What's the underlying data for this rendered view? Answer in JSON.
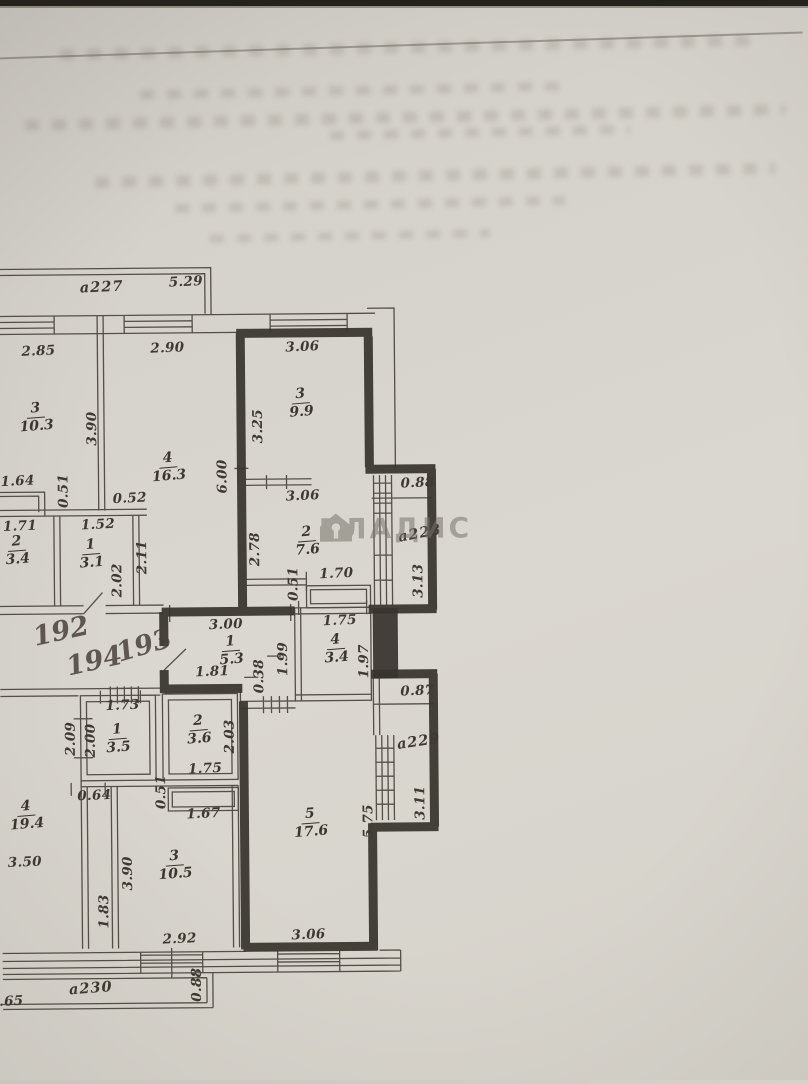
{
  "document": {
    "type": "BTI floor plan photo",
    "watermark_brand": "ВЛАДИС"
  },
  "colors": {
    "paper": "#d5d2cb",
    "ink": "#3f3931",
    "thick_wall": "#38342e",
    "watermark": "#78746c"
  },
  "apartment_numbers": [
    "192",
    "194",
    "193"
  ],
  "balconies": [
    "а227",
    "а228",
    "а229",
    "а230"
  ],
  "rooms": [
    {
      "apartment": "192",
      "number": "3",
      "area": "10.3"
    },
    {
      "apartment": "192",
      "number": "4",
      "area": "16.3"
    },
    {
      "apartment": "192",
      "number": "2",
      "area": "3.4"
    },
    {
      "apartment": "192",
      "number": "1",
      "area": "3.1"
    },
    {
      "apartment": "193",
      "number": "3",
      "area": "9.9"
    },
    {
      "apartment": "193",
      "number": "2",
      "area": "7.6"
    },
    {
      "apartment": "193",
      "number": "1",
      "area": "5.3"
    },
    {
      "apartment": "193",
      "number": "4",
      "area": "3.4"
    },
    {
      "apartment": "193",
      "number": "5",
      "area": "17.6"
    },
    {
      "apartment": "194",
      "number": "1",
      "area": "3.5"
    },
    {
      "apartment": "194",
      "number": "2",
      "area": "3.6"
    },
    {
      "apartment": "194",
      "number": "4",
      "area": "19.4"
    },
    {
      "apartment": "194",
      "number": "3",
      "area": "10.5"
    }
  ],
  "dims": [
    "5.29",
    "2.85",
    "2.90",
    "3.06",
    "3.90",
    "6.00",
    "3.25",
    "1.64",
    "0.51",
    "0.52",
    "1.71",
    "1.52",
    "2.11",
    "2.02",
    "2.78",
    "3.06",
    "0.88",
    "3.13",
    "1.70",
    "0.51",
    "1.75",
    "3.00",
    "1.81",
    "0.38",
    "1.99",
    "1.97",
    "1.73",
    "2.09",
    "2.00",
    "2.03",
    "1.75",
    "0.64",
    "0.51",
    "1.67",
    "0.87",
    "3.11",
    "5.75",
    "3.50",
    "3.90",
    "1.83",
    "2.92",
    "3.06",
    "0.88",
    ".65"
  ]
}
